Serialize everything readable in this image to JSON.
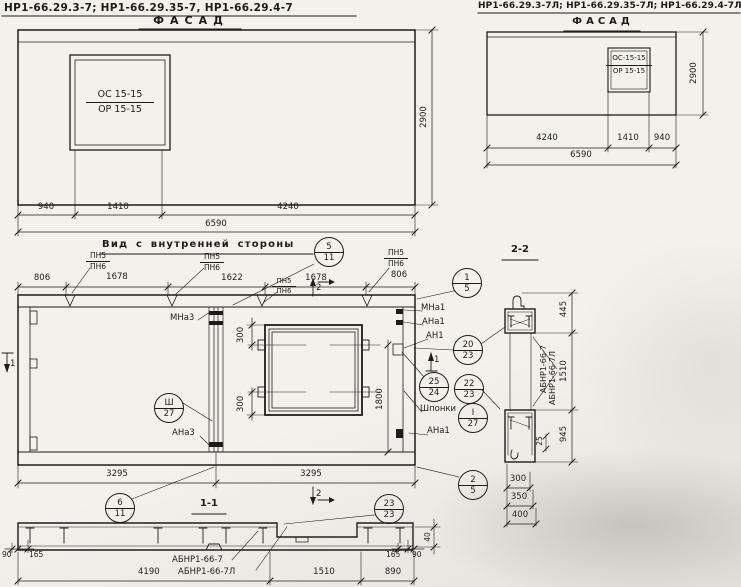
{
  "colors": {
    "paper": "#f2f1ec",
    "ink": "#1d1c1a"
  },
  "facade_left": {
    "title": "НР1-66.29.3-7;  НР1-66.29.35-7,  НР1-66.29.4-7",
    "view_label": "ФАСАД",
    "window_mark_top": "ОС 15-15",
    "window_mark_bottom": "ОР 15-15",
    "dim_a": "940",
    "dim_b": "1410",
    "dim_c": "4240",
    "dim_total": "6590",
    "dim_height": "2900"
  },
  "facade_right": {
    "title": "НР1-66.29.3-7Л; НР1-66.29.35-7Л; НР1-66.29.4-7Л",
    "view_label": "ФАСАД",
    "window_mark_top": "ОС-15-15",
    "window_mark_bottom": "ОР 15-15",
    "dim_a": "4240",
    "dim_b": "1410",
    "dim_c": "940",
    "dim_total": "6590",
    "dim_height": "2900"
  },
  "inner_view": {
    "title": "Вид с внутренней стороны",
    "anchor_top": "ПН5",
    "anchor_bottom": "ПН6",
    "top_dims": [
      "806",
      "1678",
      "1622",
      "1678",
      "806"
    ],
    "window_dim_top": "300",
    "window_dim_bottom": "300",
    "window_dim_height": "1800",
    "bottom_dim_left": "3295",
    "bottom_dim_right": "3295",
    "label_mna3": "МНа3",
    "label_ana3": "АНа3",
    "label_mna1": "МНа1",
    "label_ana1": "АНа1",
    "label_an1": "АН1",
    "label_ana1_bottom": "АНа1",
    "label_shponki": "Шпонки",
    "section_mark_1": "1",
    "section_mark_2": "2"
  },
  "callouts": {
    "title_view": {
      "top": "5",
      "bottom": "11"
    },
    "top_right": {
      "top": "1",
      "bottom": "5"
    },
    "c20": {
      "top": "20",
      "bottom": "23"
    },
    "c25": {
      "top": "25",
      "bottom": "24"
    },
    "c22": {
      "top": "22",
      "bottom": "23"
    },
    "key_right": {
      "top": "I",
      "bottom": "27"
    },
    "key_left": {
      "top": "Ш",
      "bottom": "27"
    },
    "mid_rib": {
      "top": "6",
      "bottom": "11"
    },
    "c23": {
      "top": "23",
      "bottom": "23"
    },
    "bottom_right": {
      "top": "2",
      "bottom": "5"
    }
  },
  "section_2_2": {
    "title": "2-2",
    "mark_a": "АБНР1-66-7",
    "mark_b": "АБНР1-66-7Л",
    "dim_top": "445",
    "dim_mid": "1510",
    "dim_bottom": "945",
    "dim_small": "25",
    "dim_stack": [
      "300",
      "350",
      "400"
    ]
  },
  "section_1_1": {
    "title": "1-1",
    "mark_a": "АБНР1-66-7",
    "mark_b": "АБНР1-66-7Л",
    "dim_left_overhang": "90",
    "dim_left_offset": "165",
    "dim_right_offset": "165",
    "dim_right_overhang": "90",
    "dim_a": "4190",
    "dim_b": "1510",
    "dim_c": "890",
    "dim_edge": "40"
  }
}
